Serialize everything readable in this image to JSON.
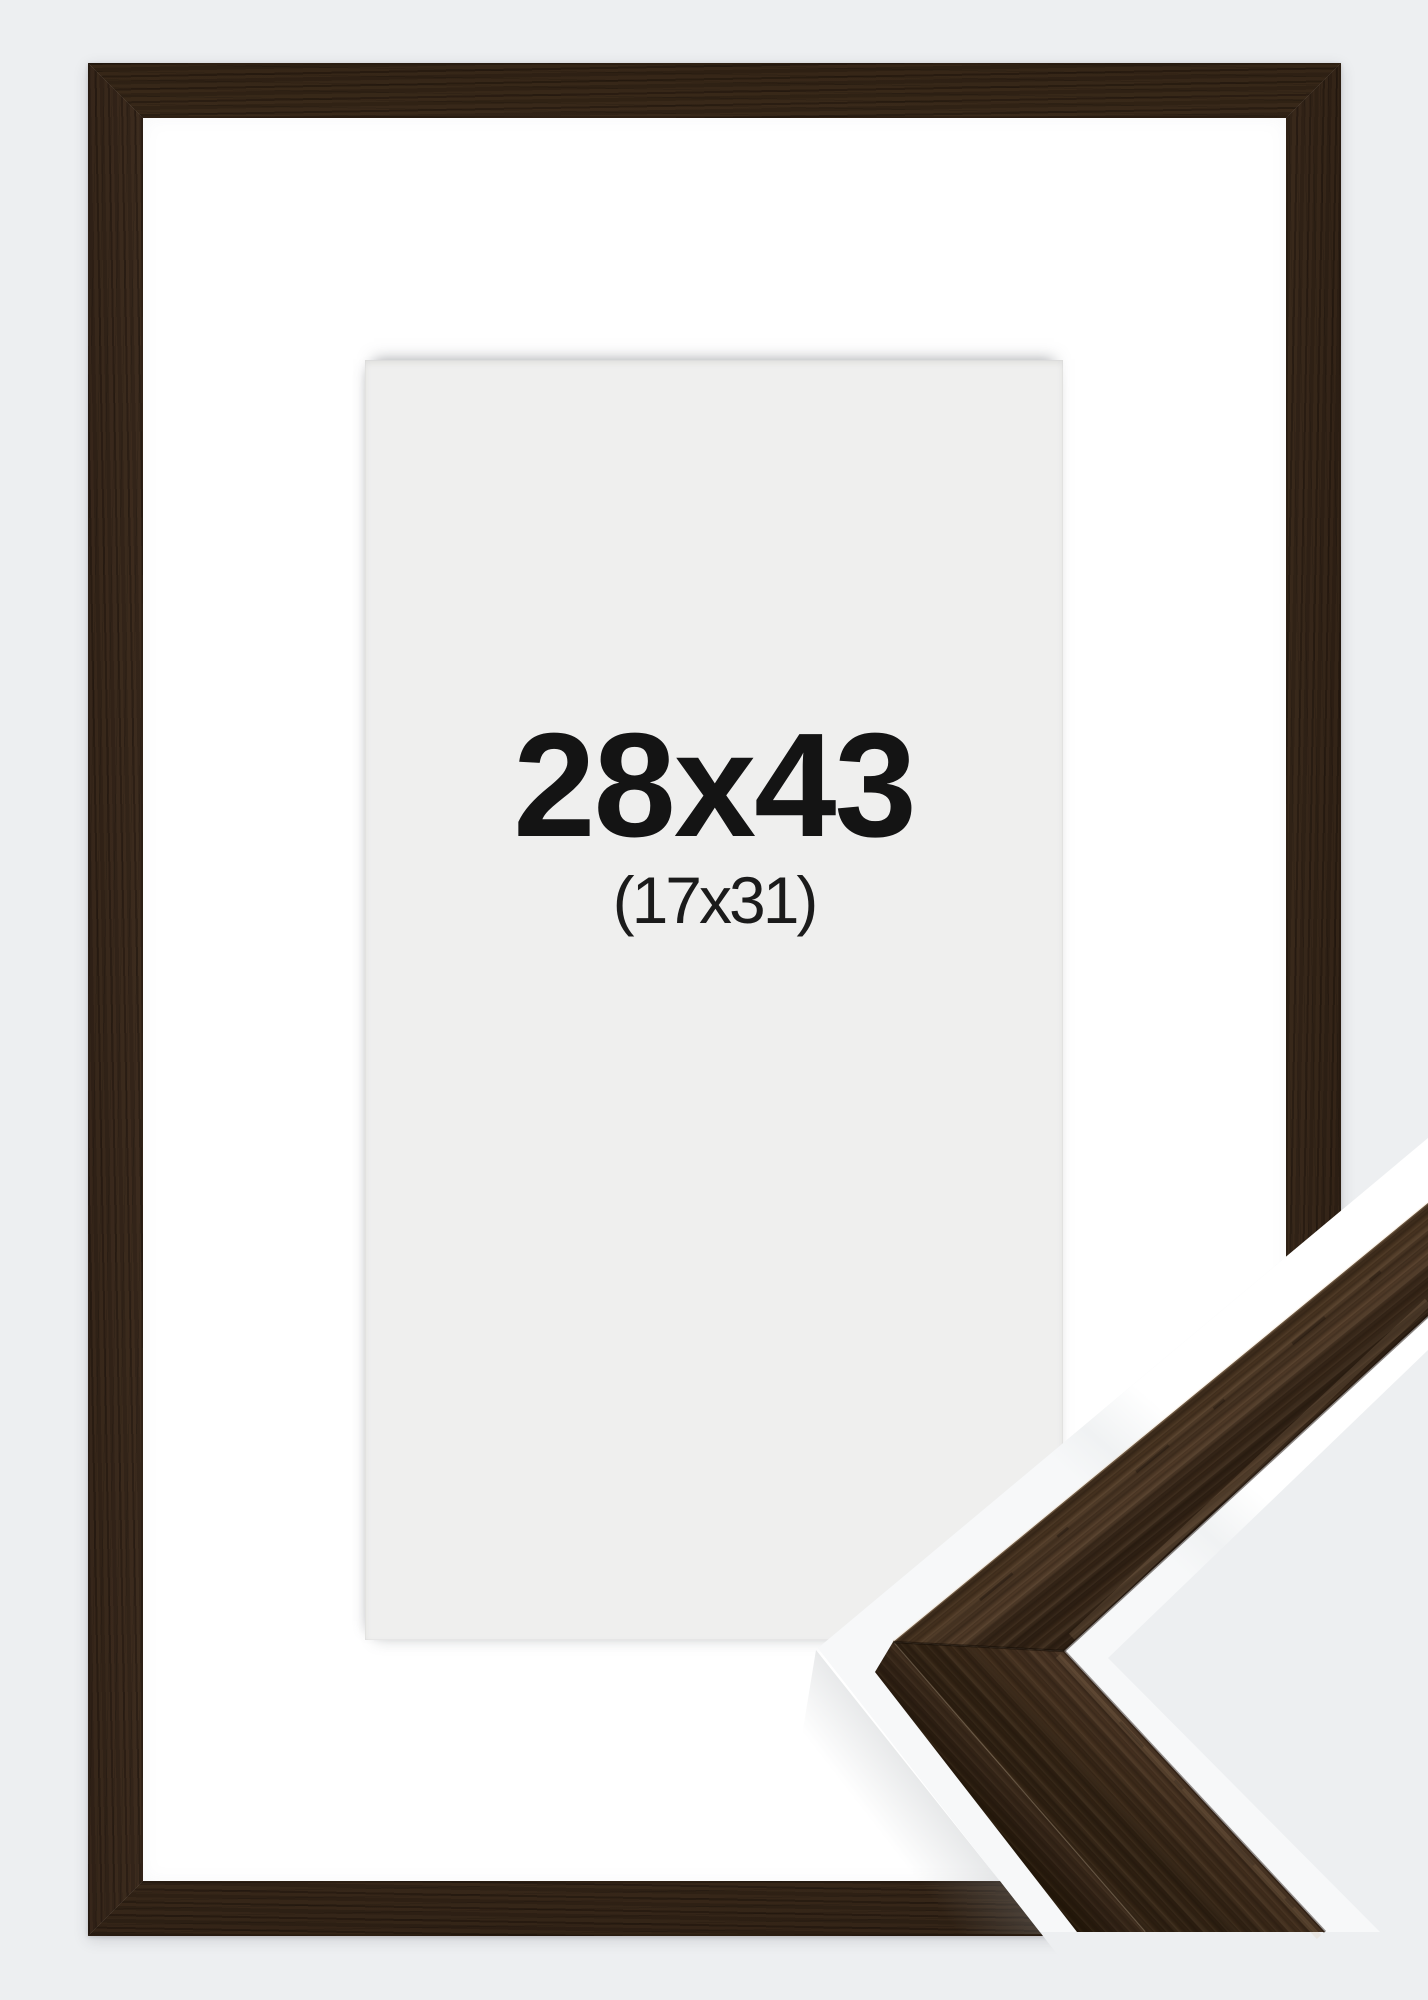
{
  "product_image": {
    "description": "framed picture product photo with corner profile sample",
    "size_label": "28x43",
    "matted_size_label": "(17x31)",
    "colors": {
      "background": "#edeff1",
      "mat": "#ffffff",
      "opening": "#efefee",
      "wood_base": "#46331f",
      "wood_light": "#5d4634",
      "wood_dark": "#2f2115",
      "wood_side_face": "#2c1e12",
      "text": "#141414"
    }
  }
}
